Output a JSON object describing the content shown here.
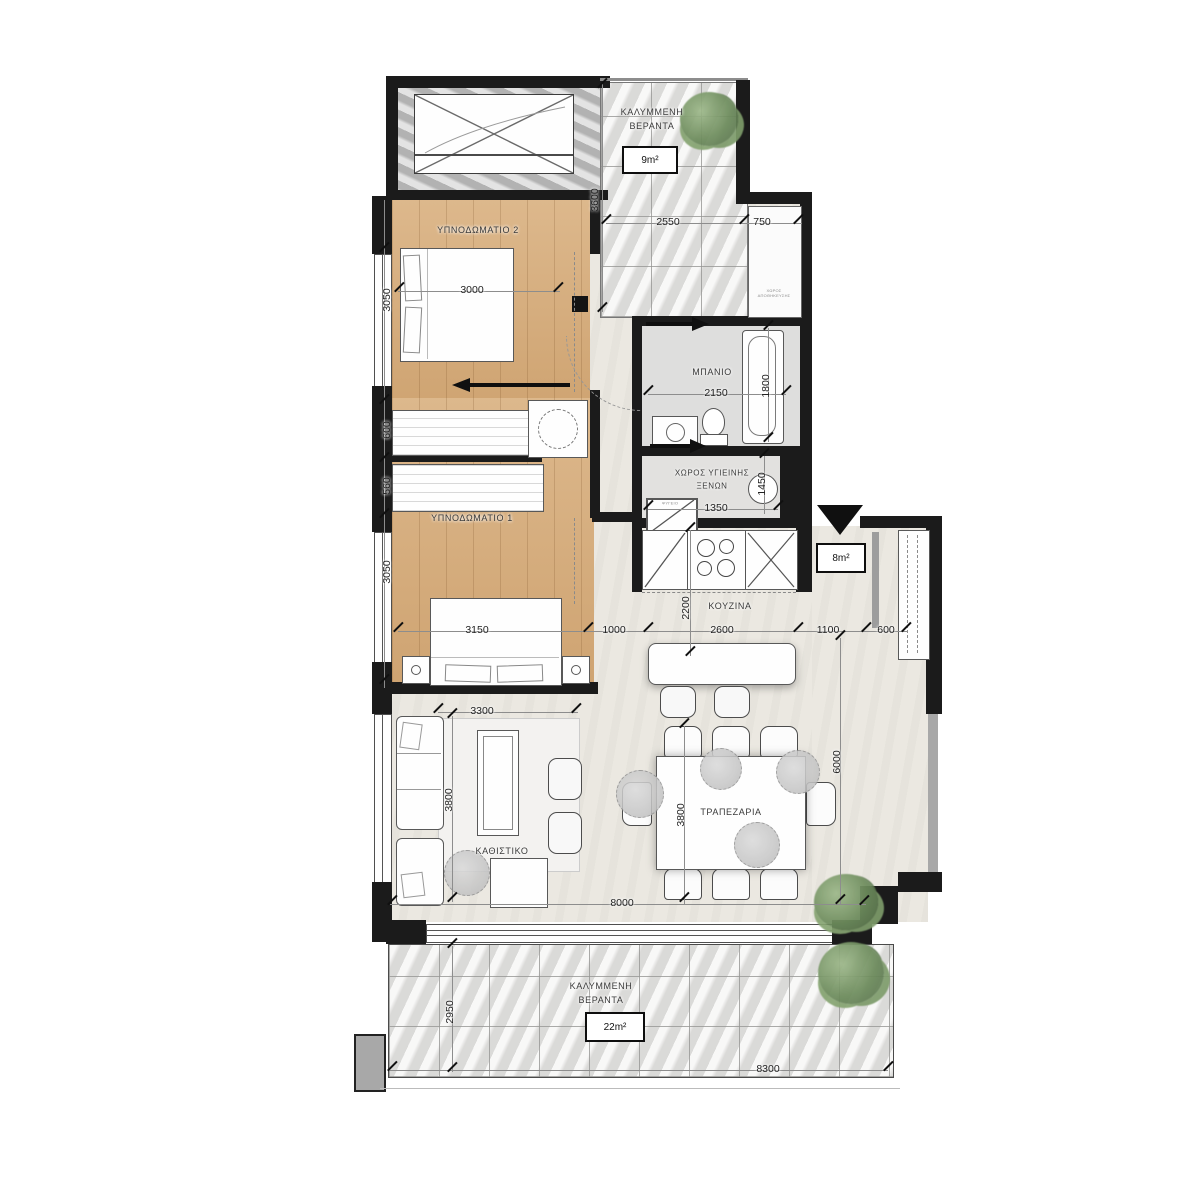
{
  "plan_title": "apartment-floor-plan",
  "rooms": {
    "veranda_top": {
      "l1": "ΚΑΛΥΜΜΕΝΗ",
      "l2": "ΒΕΡΑΝΤΑ",
      "area": "9m²"
    },
    "bedroom2": {
      "name": "ΥΠΝΟΔΩΜΑΤΙΟ 2"
    },
    "bedroom1": {
      "name": "ΥΠΝΟΔΩΜΑΤΙΟ 1"
    },
    "bathroom": {
      "name": "ΜΠΑΝΙΟ"
    },
    "guest_wc": {
      "l1": "ΧΩΡΟΣ ΥΓΙΕΙΝΗΣ",
      "l2": "ΞΕΝΩΝ"
    },
    "kitchen": {
      "name": "ΚΟΥΖΙΝΑ"
    },
    "dining": {
      "name": "ΤΡΑΠΕΖΑΡΙΑ"
    },
    "living": {
      "name": "ΚΑΘΙΣΤΙΚΟ"
    },
    "veranda_bottom": {
      "l1": "ΚΑΛΥΜΜΕΝΗ",
      "l2": "ΒΕΡΑΝΤΑ",
      "area": "22m²"
    },
    "hall": {
      "area": "8m²"
    },
    "shaft": {
      "l1": "ΧΩΡΟΣ",
      "l2": "ΑΠΟΘΗΚΕΥΣΗΣ"
    },
    "fridge": {
      "label": "ΨΥΓΕΙΟ"
    }
  },
  "dims": {
    "top_veranda_v": "3600",
    "top_w1": "2550",
    "top_w2": "750",
    "bed2_w": "3000",
    "bed2_v": "3050",
    "closet1": "600",
    "closet2": "560",
    "bed1_v": "3050",
    "bed1_w": "3150",
    "bath_w": "2150",
    "bath_v": "1800",
    "wc_v": "1450",
    "wc_w": "1350",
    "k1": "1000",
    "k2": "2600",
    "k3": "1100",
    "k4": "600",
    "k_v": "2200",
    "living_w": "3300",
    "living_v": "3800",
    "dining_v": "3800",
    "right_v": "6000",
    "interior_w": "8000",
    "veranda_b_v": "2950",
    "veranda_b_w": "8300"
  },
  "colors": {
    "wall": "#1b1b1b",
    "wood_floor": "#d8ae7c",
    "marble": "#e7e6e4",
    "interior_floor": "#ebe8e1",
    "plant": "#6d8c5c",
    "dim_text": "#222222"
  }
}
